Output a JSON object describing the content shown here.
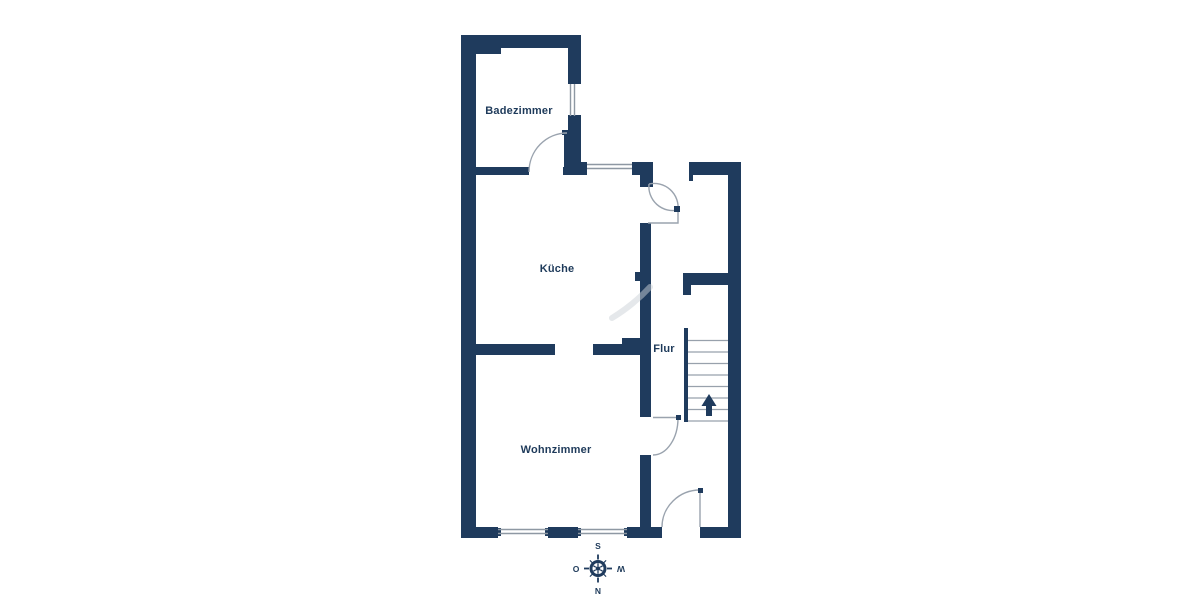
{
  "image": {
    "type": "floor-plan",
    "background": "#ffffff"
  },
  "colors": {
    "wall": "#1f3b5d",
    "text": "#1e3a5a",
    "door_line": "#9aa3ae",
    "window_line": "#8e98a3",
    "stair_line": "#98a1ac",
    "watermark": "#ccd1d7",
    "background": "#ffffff"
  },
  "rooms": {
    "badezimmer": {
      "label": "Badezimmer"
    },
    "kueche": {
      "label": "Küche"
    },
    "flur": {
      "label": "Flur"
    },
    "wohnzimmer": {
      "label": "Wohnzimmer"
    }
  },
  "compass": {
    "top": "S",
    "left": "O",
    "right": "W",
    "bottom": "N"
  },
  "stairs": {
    "arrow_direction": "up",
    "step_count": 8,
    "top_y": 340.5,
    "spacing": 11.5,
    "x1": 688,
    "x2": 728
  }
}
